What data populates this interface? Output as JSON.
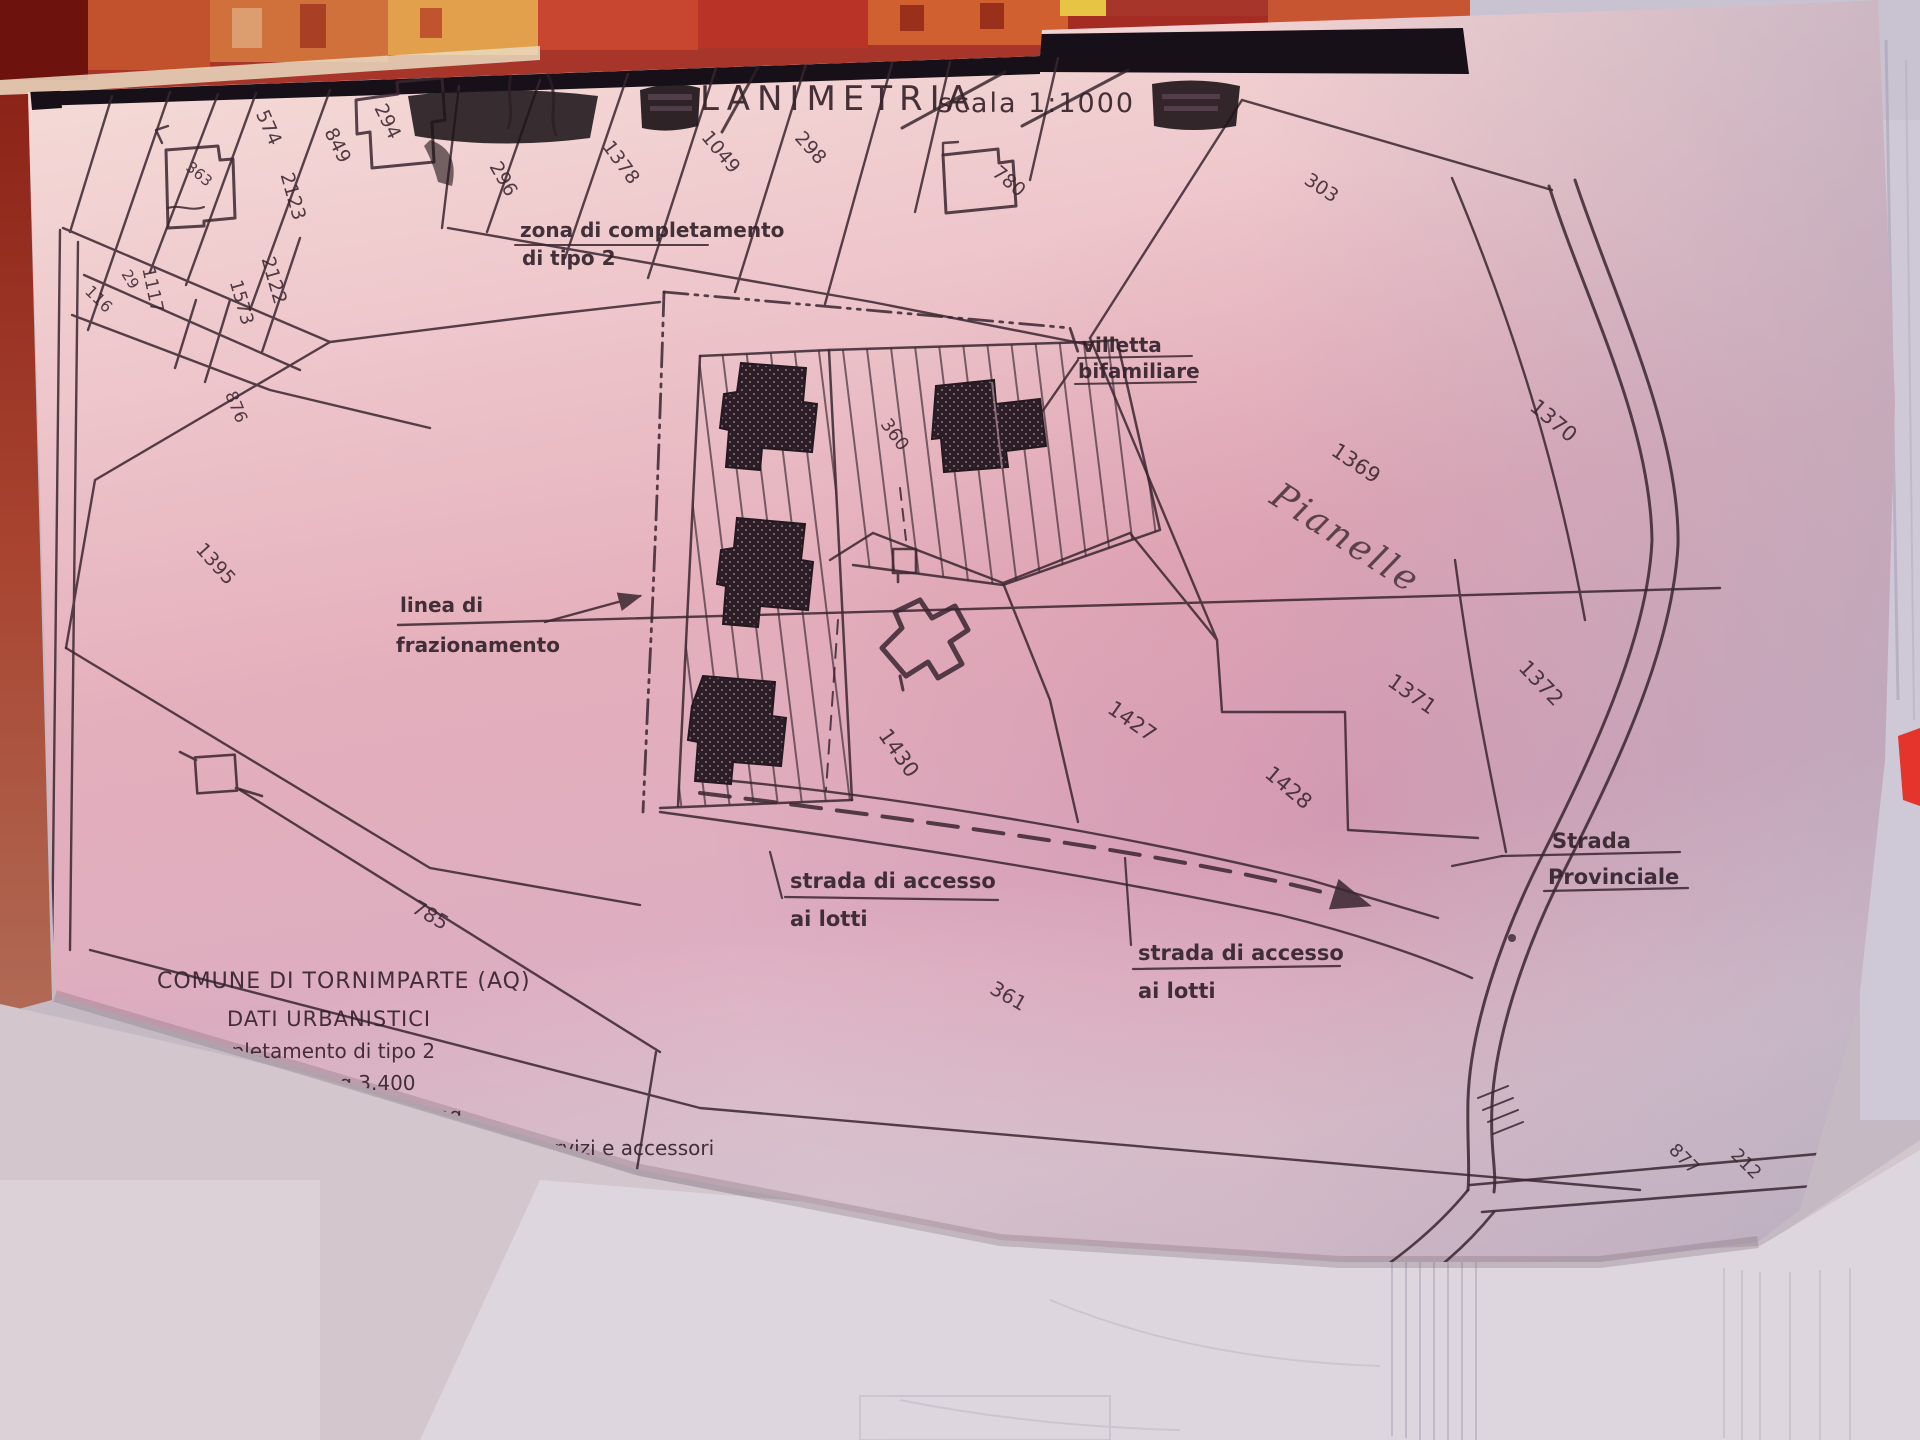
{
  "title": {
    "text": "LANIMETRIA",
    "scale_label": "scala 1:1000"
  },
  "labels": {
    "zona1": "zona di completamento",
    "zona2": "di tipo 2",
    "villetta1": "villetta",
    "villetta2": "bifamiliare",
    "linea1": "linea di",
    "linea2": "frazionamento",
    "pianelle": "Pianelle",
    "accesso1": "strada di accesso",
    "accesso2": "ai lotti",
    "strada1": "Strada",
    "strada2": "Provinciale"
  },
  "info": {
    "comune": "COMUNE DI TORNIMPARTE (AQ)",
    "dati": "DATI URBANISTICI",
    "rows": [
      "Zona di completamento di tipo 2",
      "Superfice edificabile mq 3.400",
      "Indice di fabbricabilità 0,80 mc/mq",
      "Volume massimo realizzabile 2720 mc + servizi e accessori",
      "Superficie realizzabile mq 938 + servizi e accessori"
    ]
  },
  "parcel_numbers": [
    {
      "n": "574",
      "x": 263,
      "y": 130,
      "r": 66,
      "fs": 19
    },
    {
      "n": "849",
      "x": 332,
      "y": 148,
      "r": 64,
      "fs": 19
    },
    {
      "n": "294",
      "x": 382,
      "y": 124,
      "r": 64,
      "fs": 19
    },
    {
      "n": "2123",
      "x": 287,
      "y": 198,
      "r": 74,
      "fs": 19
    },
    {
      "n": "2122",
      "x": 268,
      "y": 282,
      "r": 74,
      "fs": 19
    },
    {
      "n": "1573",
      "x": 236,
      "y": 304,
      "r": 74,
      "fs": 18
    },
    {
      "n": "1117",
      "x": 147,
      "y": 291,
      "r": 78,
      "fs": 18
    },
    {
      "n": "29",
      "x": 126,
      "y": 282,
      "r": 58,
      "fs": 15
    },
    {
      "n": "116",
      "x": 95,
      "y": 303,
      "r": 44,
      "fs": 16
    },
    {
      "n": "363",
      "x": 196,
      "y": 178,
      "r": 40,
      "fs": 15,
      "o": 0.4
    },
    {
      "n": "876",
      "x": 231,
      "y": 409,
      "r": 68,
      "fs": 17
    },
    {
      "n": "1395",
      "x": 211,
      "y": 568,
      "r": 48,
      "fs": 19
    },
    {
      "n": "296",
      "x": 498,
      "y": 182,
      "r": 60,
      "fs": 19
    },
    {
      "n": "1378",
      "x": 616,
      "y": 166,
      "r": 54,
      "fs": 19
    },
    {
      "n": "1049",
      "x": 716,
      "y": 156,
      "r": 50,
      "fs": 19
    },
    {
      "n": "298",
      "x": 806,
      "y": 152,
      "r": 48,
      "fs": 19
    },
    {
      "n": "780",
      "x": 1005,
      "y": 186,
      "r": 40,
      "fs": 19
    },
    {
      "n": "303",
      "x": 1318,
      "y": 193,
      "r": 34,
      "fs": 19
    },
    {
      "n": "360",
      "x": 890,
      "y": 438,
      "r": 54,
      "fs": 18
    },
    {
      "n": "1369",
      "x": 1352,
      "y": 469,
      "r": 34,
      "fs": 21
    },
    {
      "n": "1370",
      "x": 1549,
      "y": 426,
      "r": 40,
      "fs": 21
    },
    {
      "n": "1371",
      "x": 1408,
      "y": 700,
      "r": 35,
      "fs": 21
    },
    {
      "n": "1372",
      "x": 1536,
      "y": 688,
      "r": 46,
      "fs": 21
    },
    {
      "n": "1427",
      "x": 1128,
      "y": 727,
      "r": 35,
      "fs": 21
    },
    {
      "n": "1428",
      "x": 1284,
      "y": 793,
      "r": 40,
      "fs": 21
    },
    {
      "n": "1430",
      "x": 893,
      "y": 757,
      "r": 55,
      "fs": 21
    },
    {
      "n": "785",
      "x": 427,
      "y": 921,
      "r": 30,
      "fs": 20
    },
    {
      "n": "361",
      "x": 1005,
      "y": 1002,
      "r": 30,
      "fs": 20
    },
    {
      "n": "877",
      "x": 1680,
      "y": 1163,
      "r": 45,
      "fs": 18,
      "o": 0.75
    },
    {
      "n": "212",
      "x": 1742,
      "y": 1168,
      "r": 45,
      "fs": 18,
      "o": 0.6
    }
  ],
  "colors": {
    "ink": "#3a2630",
    "paper_pink": "#e8c0c9",
    "fabric_red": "#a8352a",
    "sleeve_gray": "#c9c2d1",
    "red_object": "#e5342b"
  }
}
